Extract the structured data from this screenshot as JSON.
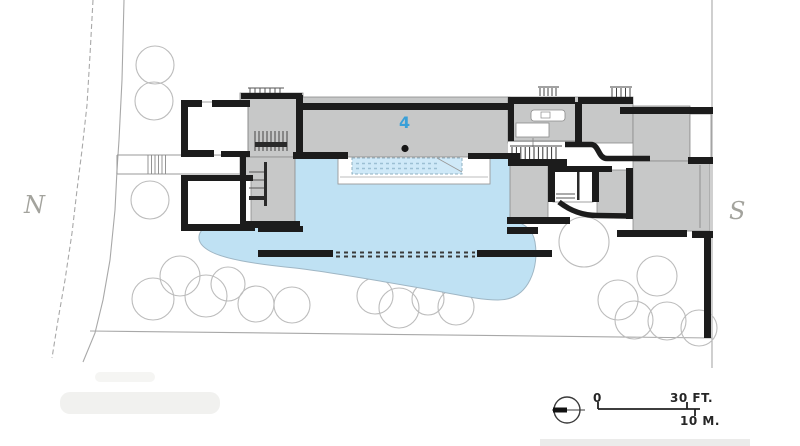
{
  "labels": {
    "north": "N",
    "south": "S",
    "building_number": "4"
  },
  "scale_bar": {
    "zero": "0",
    "imperial": "30 FT.",
    "metric": "10 M."
  },
  "colors": {
    "pond_blue": "#bfe1f3",
    "pool_blue": "#cfe9f8",
    "building_fill": "#c7c8c8",
    "wall_black": "#1c1c1c",
    "accent_blue": "#3aa0d8",
    "tree_stroke": "#bcbcbc",
    "site_line_gray": "#a8a8a8",
    "compass_label_gray": "#a3a39d"
  },
  "plan": {
    "trees": [
      [
        155,
        65,
        19
      ],
      [
        154,
        101,
        19
      ],
      [
        150,
        200,
        19
      ],
      [
        153,
        299,
        21
      ],
      [
        180,
        276,
        20
      ],
      [
        206,
        296,
        21
      ],
      [
        228,
        284,
        17
      ],
      [
        256,
        304,
        18
      ],
      [
        292,
        305,
        18
      ],
      [
        375,
        296,
        18
      ],
      [
        399,
        308,
        20
      ],
      [
        428,
        299,
        16
      ],
      [
        456,
        307,
        18
      ],
      [
        584,
        242,
        25
      ],
      [
        657,
        276,
        20
      ],
      [
        618,
        300,
        20
      ],
      [
        634,
        320,
        19
      ],
      [
        667,
        321,
        19
      ],
      [
        699,
        328,
        18
      ]
    ],
    "walls": [
      [
        181,
        100,
        21,
        7
      ],
      [
        212,
        100,
        38,
        7
      ],
      [
        181,
        100,
        7,
        57
      ],
      [
        181,
        150,
        33,
        7
      ],
      [
        221,
        151,
        29,
        6
      ],
      [
        241,
        93,
        61,
        6
      ],
      [
        296,
        95,
        7,
        61
      ],
      [
        240,
        157,
        6,
        71
      ],
      [
        241,
        221,
        59,
        7
      ],
      [
        181,
        175,
        72,
        6
      ],
      [
        181,
        176,
        7,
        55
      ],
      [
        181,
        224,
        74,
        7
      ],
      [
        258,
        226,
        45,
        6
      ],
      [
        296,
        103,
        216,
        7
      ],
      [
        293,
        152,
        55,
        7
      ],
      [
        468,
        153,
        52,
        6
      ],
      [
        508,
        97,
        67,
        7
      ],
      [
        578,
        97,
        55,
        7
      ],
      [
        508,
        97,
        6,
        44
      ],
      [
        575,
        102,
        7,
        41
      ],
      [
        620,
        107,
        93,
        7
      ],
      [
        688,
        157,
        25,
        7
      ],
      [
        508,
        159,
        59,
        7
      ],
      [
        507,
        217,
        63,
        7
      ],
      [
        548,
        166,
        64,
        6
      ],
      [
        548,
        170,
        7,
        32
      ],
      [
        592,
        168,
        7,
        34
      ],
      [
        626,
        168,
        7,
        51
      ],
      [
        617,
        230,
        70,
        7
      ],
      [
        692,
        231,
        21,
        7
      ],
      [
        704,
        233,
        7,
        105
      ],
      [
        258,
        250,
        75,
        7
      ],
      [
        477,
        250,
        75,
        7
      ],
      [
        507,
        227,
        31,
        7
      ]
    ]
  }
}
